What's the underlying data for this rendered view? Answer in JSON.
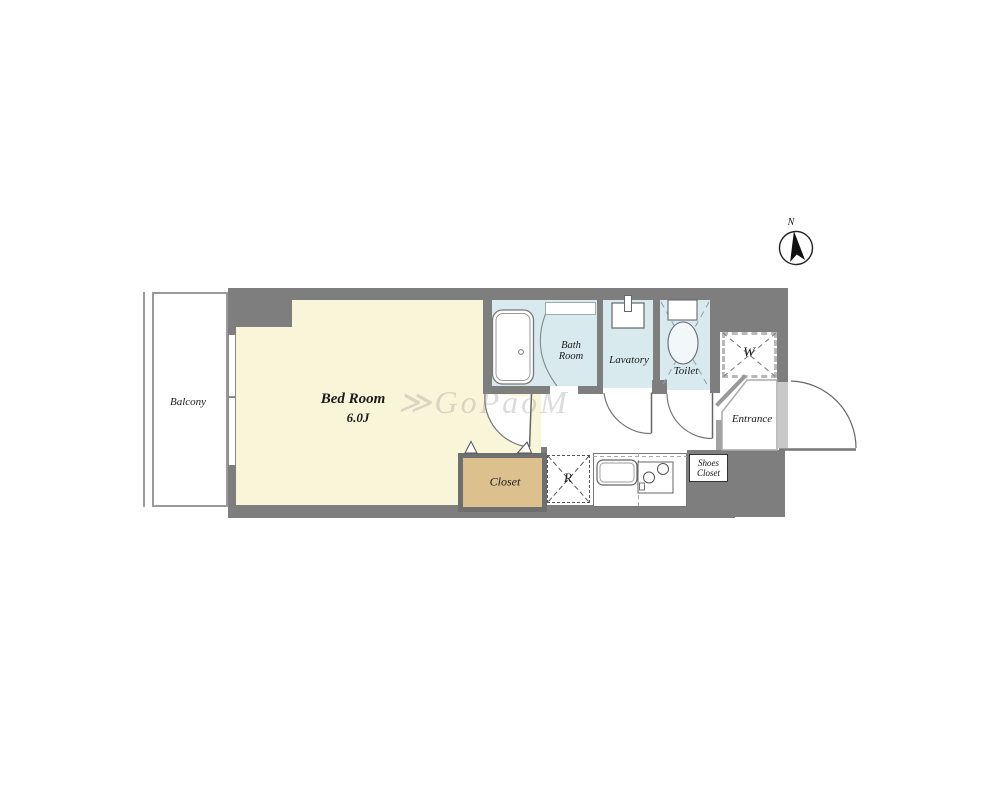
{
  "compass": {
    "label": "N"
  },
  "watermark": "≫GoPaoM",
  "rooms": {
    "balcony": {
      "label": "Balcony"
    },
    "bedroom": {
      "label": "Bed Room",
      "size": "6.0J"
    },
    "bathroom": {
      "line1": "Bath",
      "line2": "Room"
    },
    "lavatory": {
      "label": "Lavatory"
    },
    "toilet": {
      "label": "Toilet"
    },
    "closet": {
      "label": "Closet"
    },
    "entrance": {
      "label": "Entrance"
    },
    "shoes_closet": {
      "line1": "Shoes",
      "line2": "Closet"
    },
    "washer": {
      "label": "W"
    },
    "refrigerator": {
      "label": "R"
    }
  },
  "colors": {
    "wall": "#7e7e7e",
    "bedroom_floor": "#f9f5d9",
    "wet_area_floor": "#d9eaee",
    "closet_floor": "#dcc18f",
    "background": "#ffffff"
  }
}
